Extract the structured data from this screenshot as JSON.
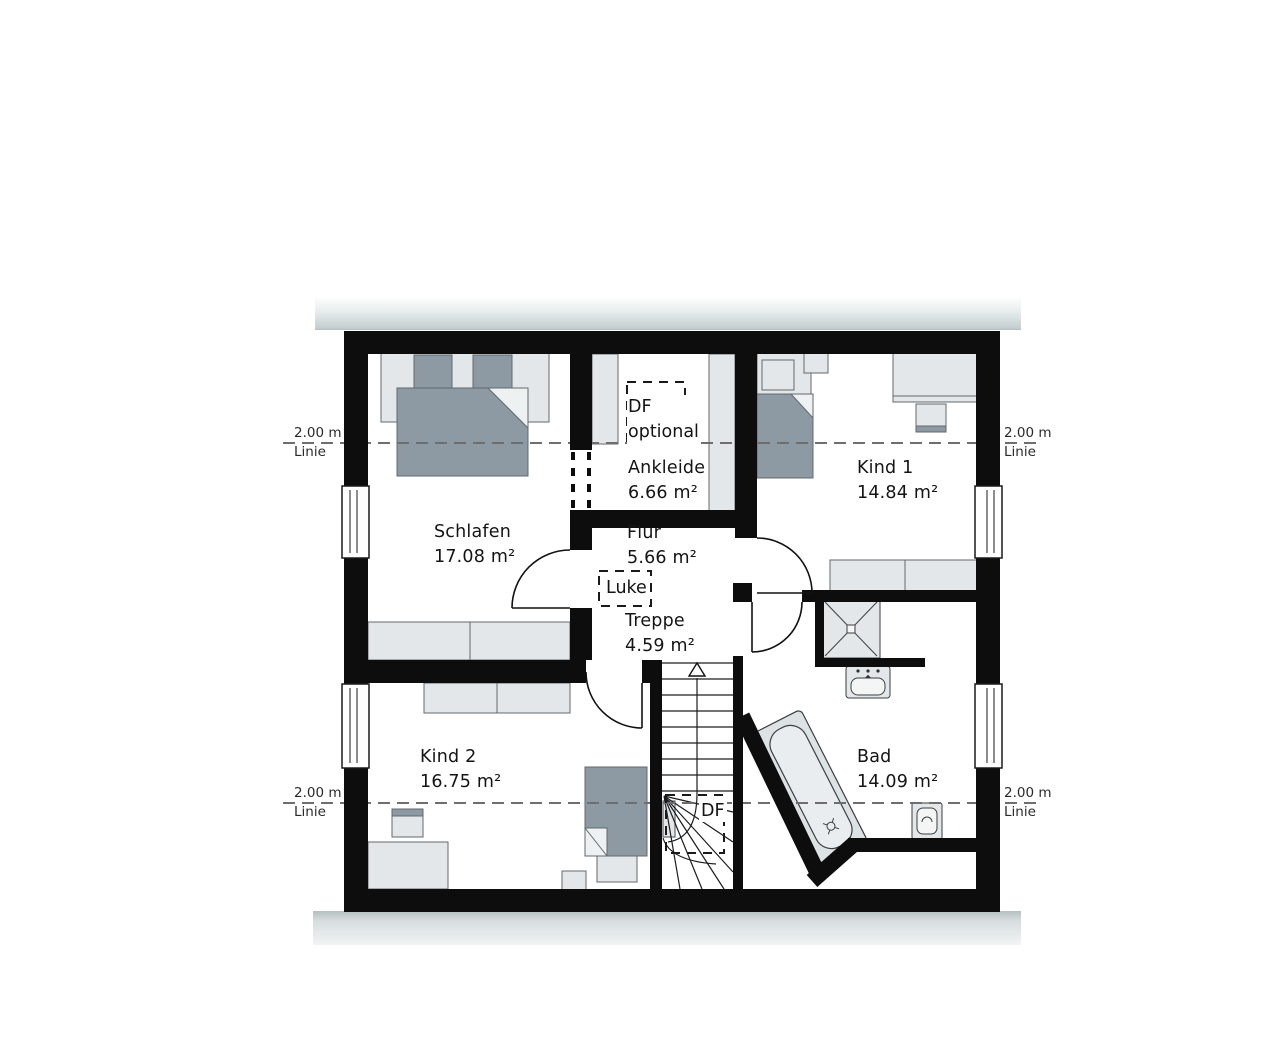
{
  "rooms": [
    {
      "name": "Schlafen",
      "area": "17.08 m²"
    },
    {
      "name": "Ankleide",
      "area": "6.66 m²"
    },
    {
      "name": "Kind 1",
      "area": "14.84 m²"
    },
    {
      "name": "Flur",
      "area": "5.66 m²"
    },
    {
      "name": "Treppe",
      "area": "4.59 m²"
    },
    {
      "name": "Kind 2",
      "area": "16.75 m²"
    },
    {
      "name": "Bad",
      "area": "14.09 m²"
    }
  ],
  "annotations": {
    "roof_window_optional": {
      "line1": "DF",
      "line2": "optional"
    },
    "attic_hatch": "Luke",
    "roof_window": "DF"
  },
  "height_markers": {
    "value": "2.00 m",
    "caption": "Linie"
  },
  "colors": {
    "wall": "#0d0d0d",
    "furniture_light": "#e3e7ea",
    "furniture_dark": "#8d9aa4",
    "eave_gray": "#c6cfd2",
    "dash_line": "#6e6e6e"
  }
}
